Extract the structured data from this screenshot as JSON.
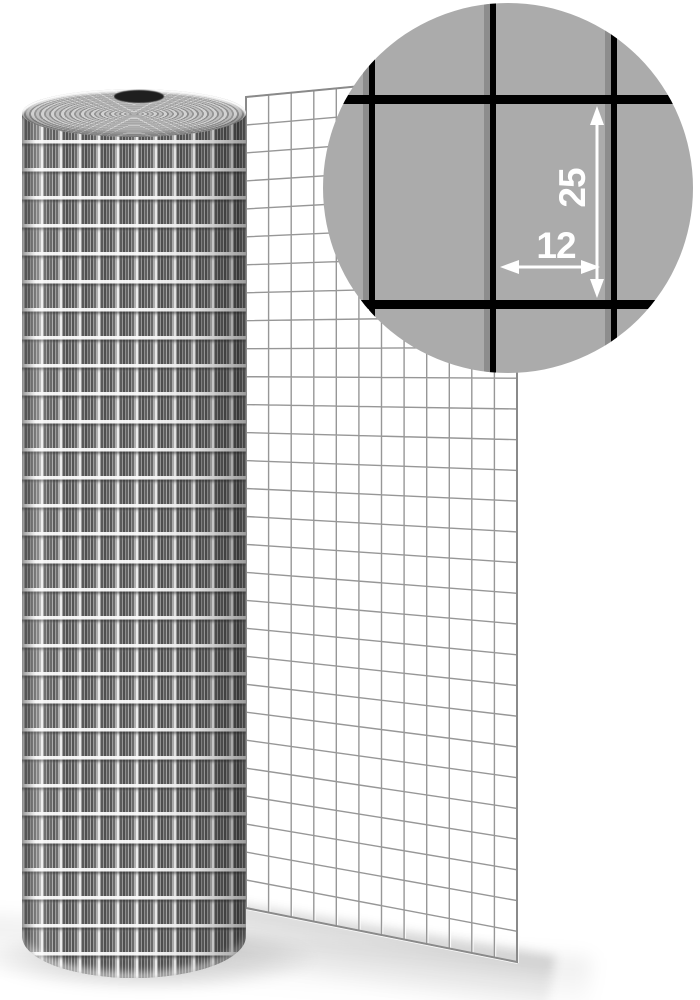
{
  "image_description": "Roll of galvanized welded wire mesh with unrolled sheet and magnified detail circle showing cell dimensions",
  "background_color": "#ffffff",
  "roll": {
    "kind": "galvanized-welded-mesh-roll",
    "base_color": "#b3b3b3",
    "core_hole_color": "#1f1f1f"
  },
  "sheet": {
    "grid_color": "#979797",
    "highlight_color": "#ffffff",
    "columns": 12,
    "rows": 29,
    "top_left": [
      246,
      97
    ],
    "top_right": [
      517,
      71
    ],
    "bottom_left": [
      246,
      908
    ],
    "bottom_right": [
      517,
      962
    ]
  },
  "magnifier": {
    "fill_color": "#ababab",
    "wire_color": "#000000",
    "wire_shadow_color": "#8d8d8d",
    "arrow_color": "#ffffff",
    "labels": {
      "cell_height_mm": "25",
      "cell_width_mm": "12"
    }
  }
}
